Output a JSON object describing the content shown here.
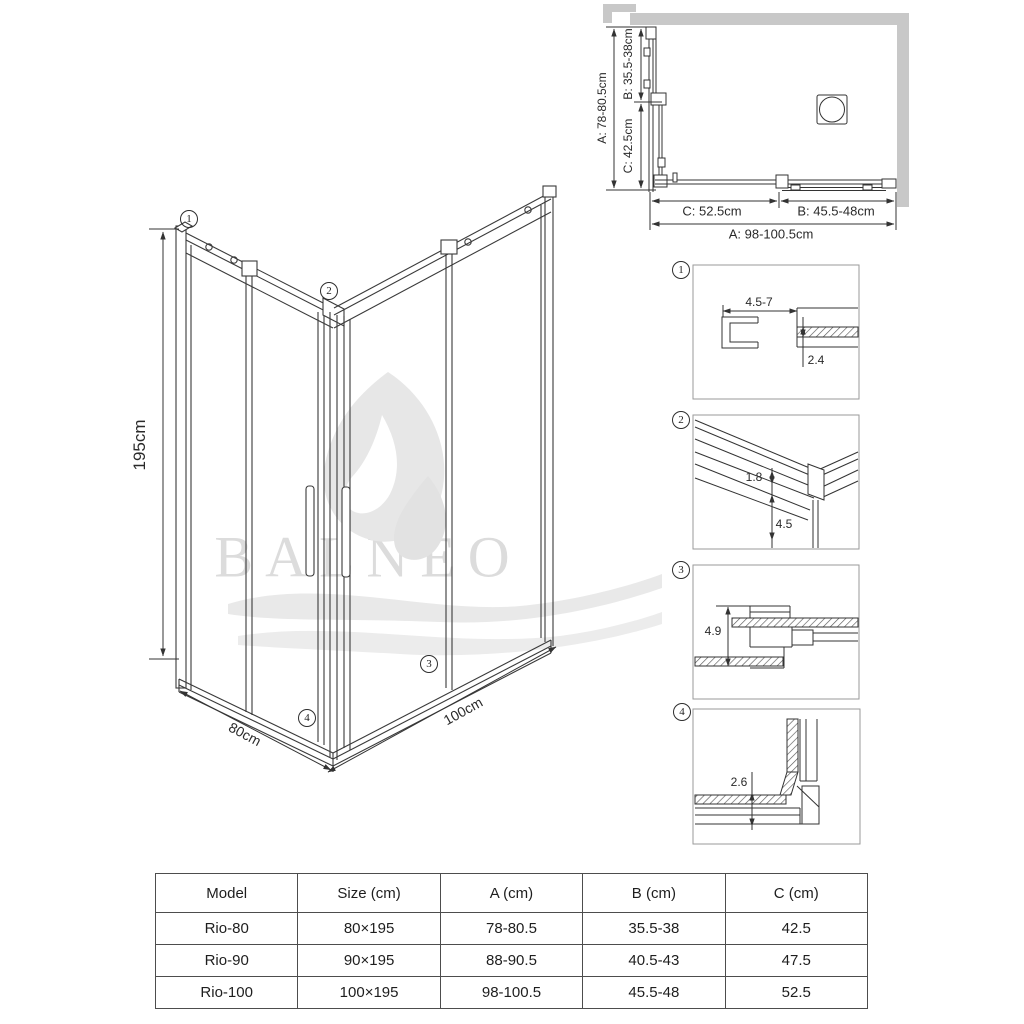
{
  "brand_watermark": "BALNEO",
  "main_drawing": {
    "height_label": "195cm",
    "depth_label": "80cm",
    "width_label": "100cm",
    "callouts": [
      "1",
      "2",
      "3",
      "4"
    ]
  },
  "plan_view": {
    "left_dims": [
      "A: 78-80.5cm",
      "B: 35.5-38cm",
      "C: 42.5cm"
    ],
    "bottom_dims": [
      "C: 52.5cm",
      "B: 45.5-48cm",
      "A: 98-100.5cm"
    ]
  },
  "details": [
    {
      "number": "1",
      "dims": [
        "4.5-7",
        "2.4"
      ]
    },
    {
      "number": "2",
      "dims": [
        "1.8",
        "4.5"
      ]
    },
    {
      "number": "3",
      "dims": [
        "4.9"
      ]
    },
    {
      "number": "4",
      "dims": [
        "2.6"
      ]
    }
  ],
  "table": {
    "headers": [
      "Model",
      "Size (cm)",
      "A (cm)",
      "B (cm)",
      "C (cm)"
    ],
    "rows": [
      [
        "Rio-80",
        "80×195",
        "78-80.5",
        "35.5-38",
        "42.5"
      ],
      [
        "Rio-90",
        "90×195",
        "88-90.5",
        "40.5-43",
        "47.5"
      ],
      [
        "Rio-100",
        "100×195",
        "98-100.5",
        "45.5-48",
        "52.5"
      ]
    ]
  }
}
